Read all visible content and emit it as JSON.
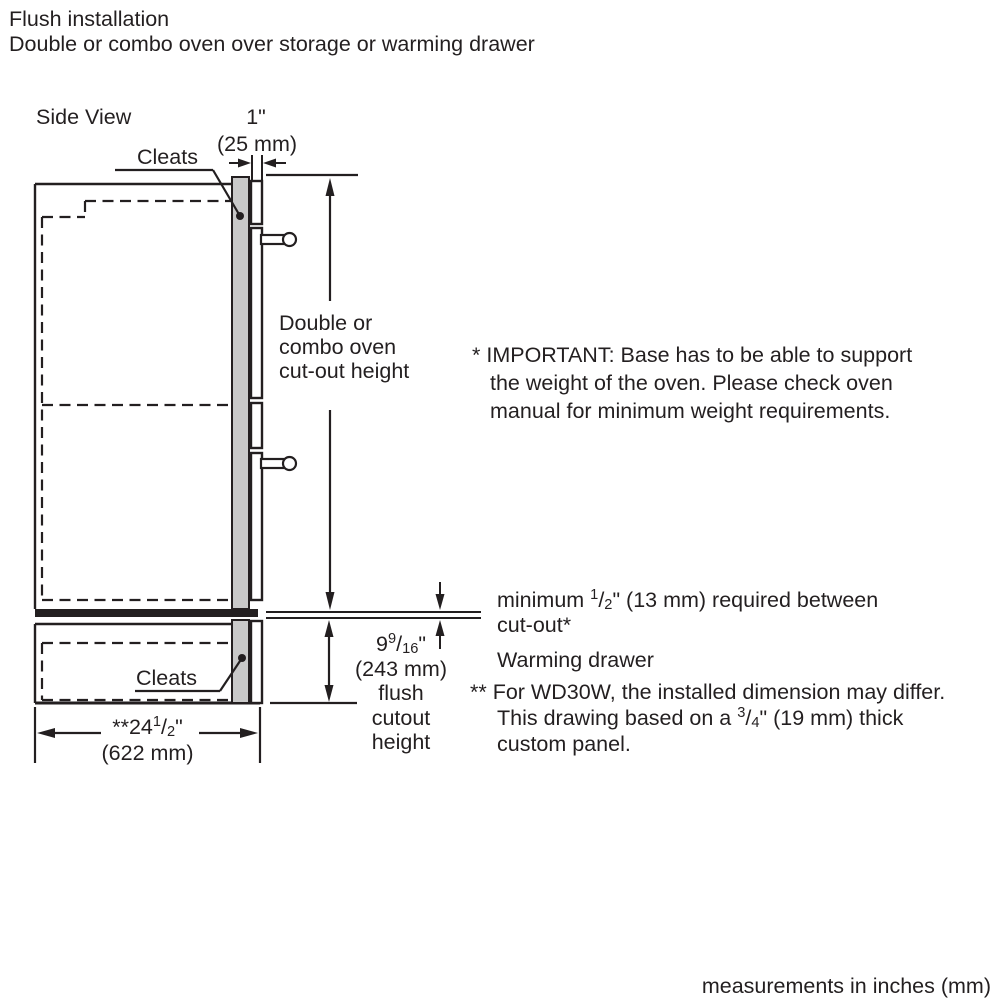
{
  "page": {
    "title_line1": "Flush installation",
    "title_line2": "Double or combo oven over storage or warming drawer",
    "footer": "measurements in inches (mm)"
  },
  "diagram": {
    "view_label": "Side View",
    "cleats_top_label": "Cleats",
    "cleats_bottom_label": "Cleats",
    "cutout_height_label": [
      "Double or",
      "combo oven",
      "cut-out height"
    ],
    "dim_panel_gap": {
      "inches": "1\"",
      "mm": "(25 mm)"
    },
    "dim_flush_cutout": {
      "whole": "9",
      "num": "9",
      "sep": "/",
      "den": "16",
      "unit": "\"",
      "mm": "(243 mm)",
      "desc": [
        "flush",
        "cutout",
        "height"
      ]
    },
    "dim_width": {
      "prefix": "**24",
      "num": "1",
      "sep": "/",
      "den": "2",
      "unit": "\"",
      "mm": "(622 mm)"
    }
  },
  "notes": {
    "important": [
      "* IMPORTANT: Base has to be able to support",
      "the weight of the oven. Please check oven",
      "manual for minimum weight requirements."
    ],
    "min_gap": {
      "prefix": "minimum ",
      "num": "1",
      "sep": "/",
      "den": "2",
      "suffix": "\" (13 mm) required between",
      "line2": "cut-out*"
    },
    "warming_drawer": "Warming drawer",
    "wd30w": {
      "line1": "** For WD30W, the installed dimension may differ.",
      "line2_prefix": "This drawing based on a ",
      "num": "3",
      "sep": "/",
      "den": "4",
      "line2_suffix": "\" (19 mm) thick",
      "line3": "custom panel."
    }
  },
  "colors": {
    "ink": "#231f20",
    "panel_fill": "#c9c9c9",
    "background": "#ffffff"
  }
}
